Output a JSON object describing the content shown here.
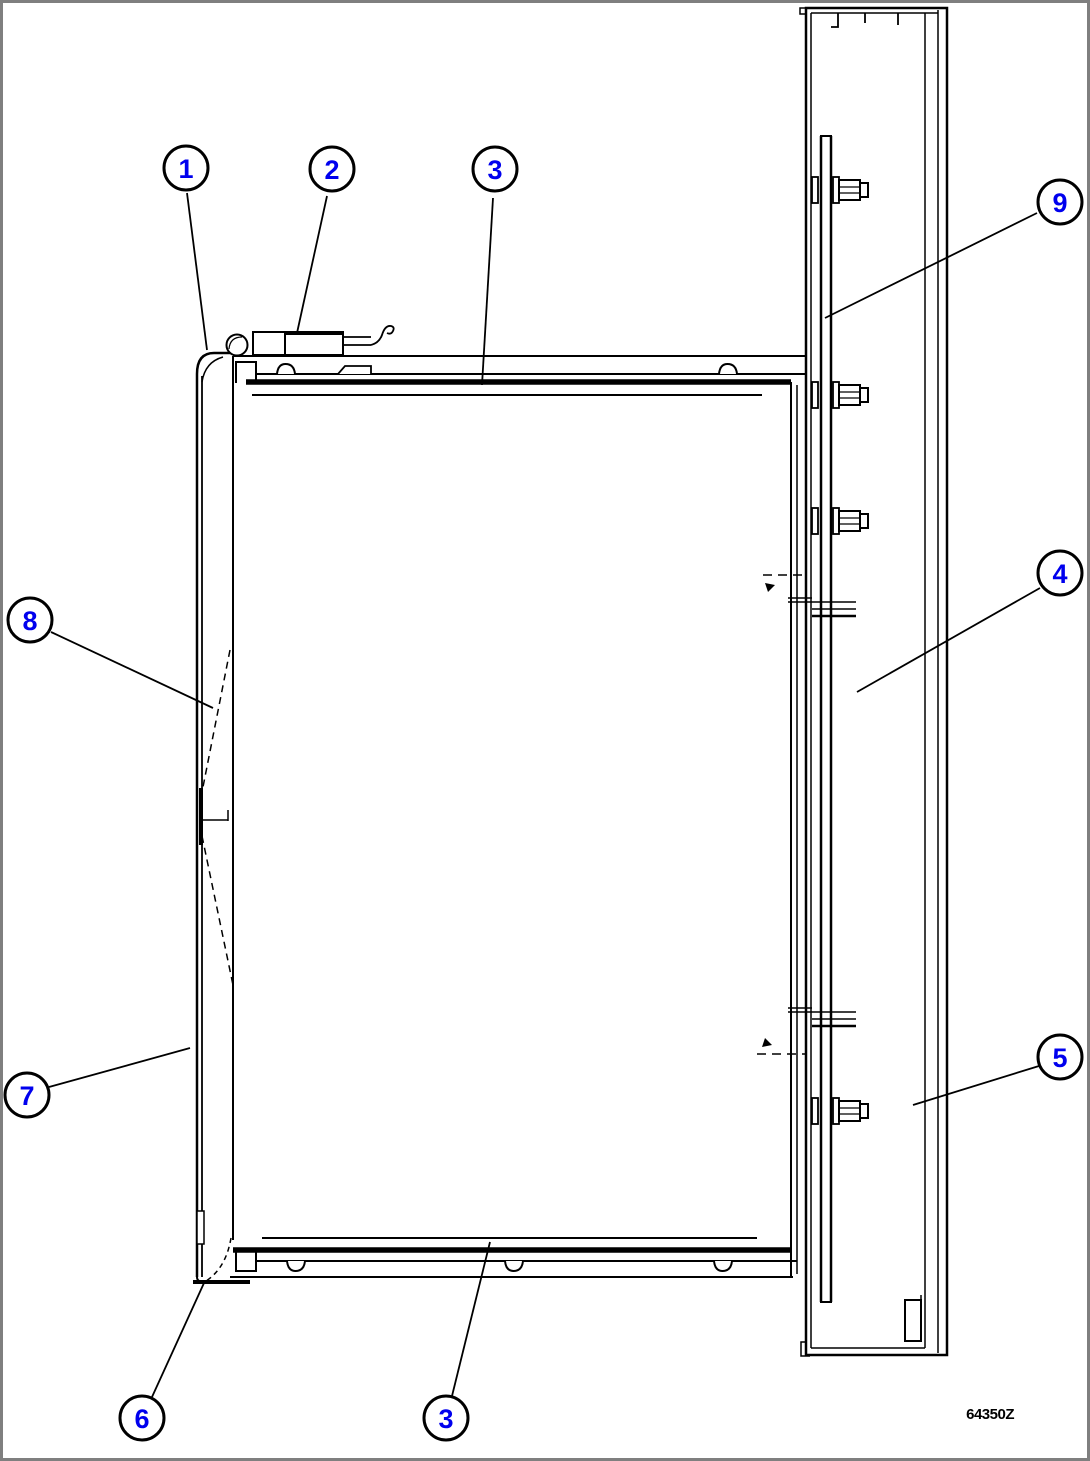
{
  "drawing": {
    "id_label": "64350Z",
    "callouts": [
      {
        "num": "1"
      },
      {
        "num": "2"
      },
      {
        "num": "3"
      },
      {
        "num": "9"
      },
      {
        "num": "4"
      },
      {
        "num": "8"
      },
      {
        "num": "7"
      },
      {
        "num": "5"
      },
      {
        "num": "6"
      },
      {
        "num": "3"
      }
    ]
  },
  "colors": {
    "callout_number": "#0000EE",
    "line": "#000000",
    "background": "#FFFFFF",
    "frame_border": "#7F7F7F"
  }
}
